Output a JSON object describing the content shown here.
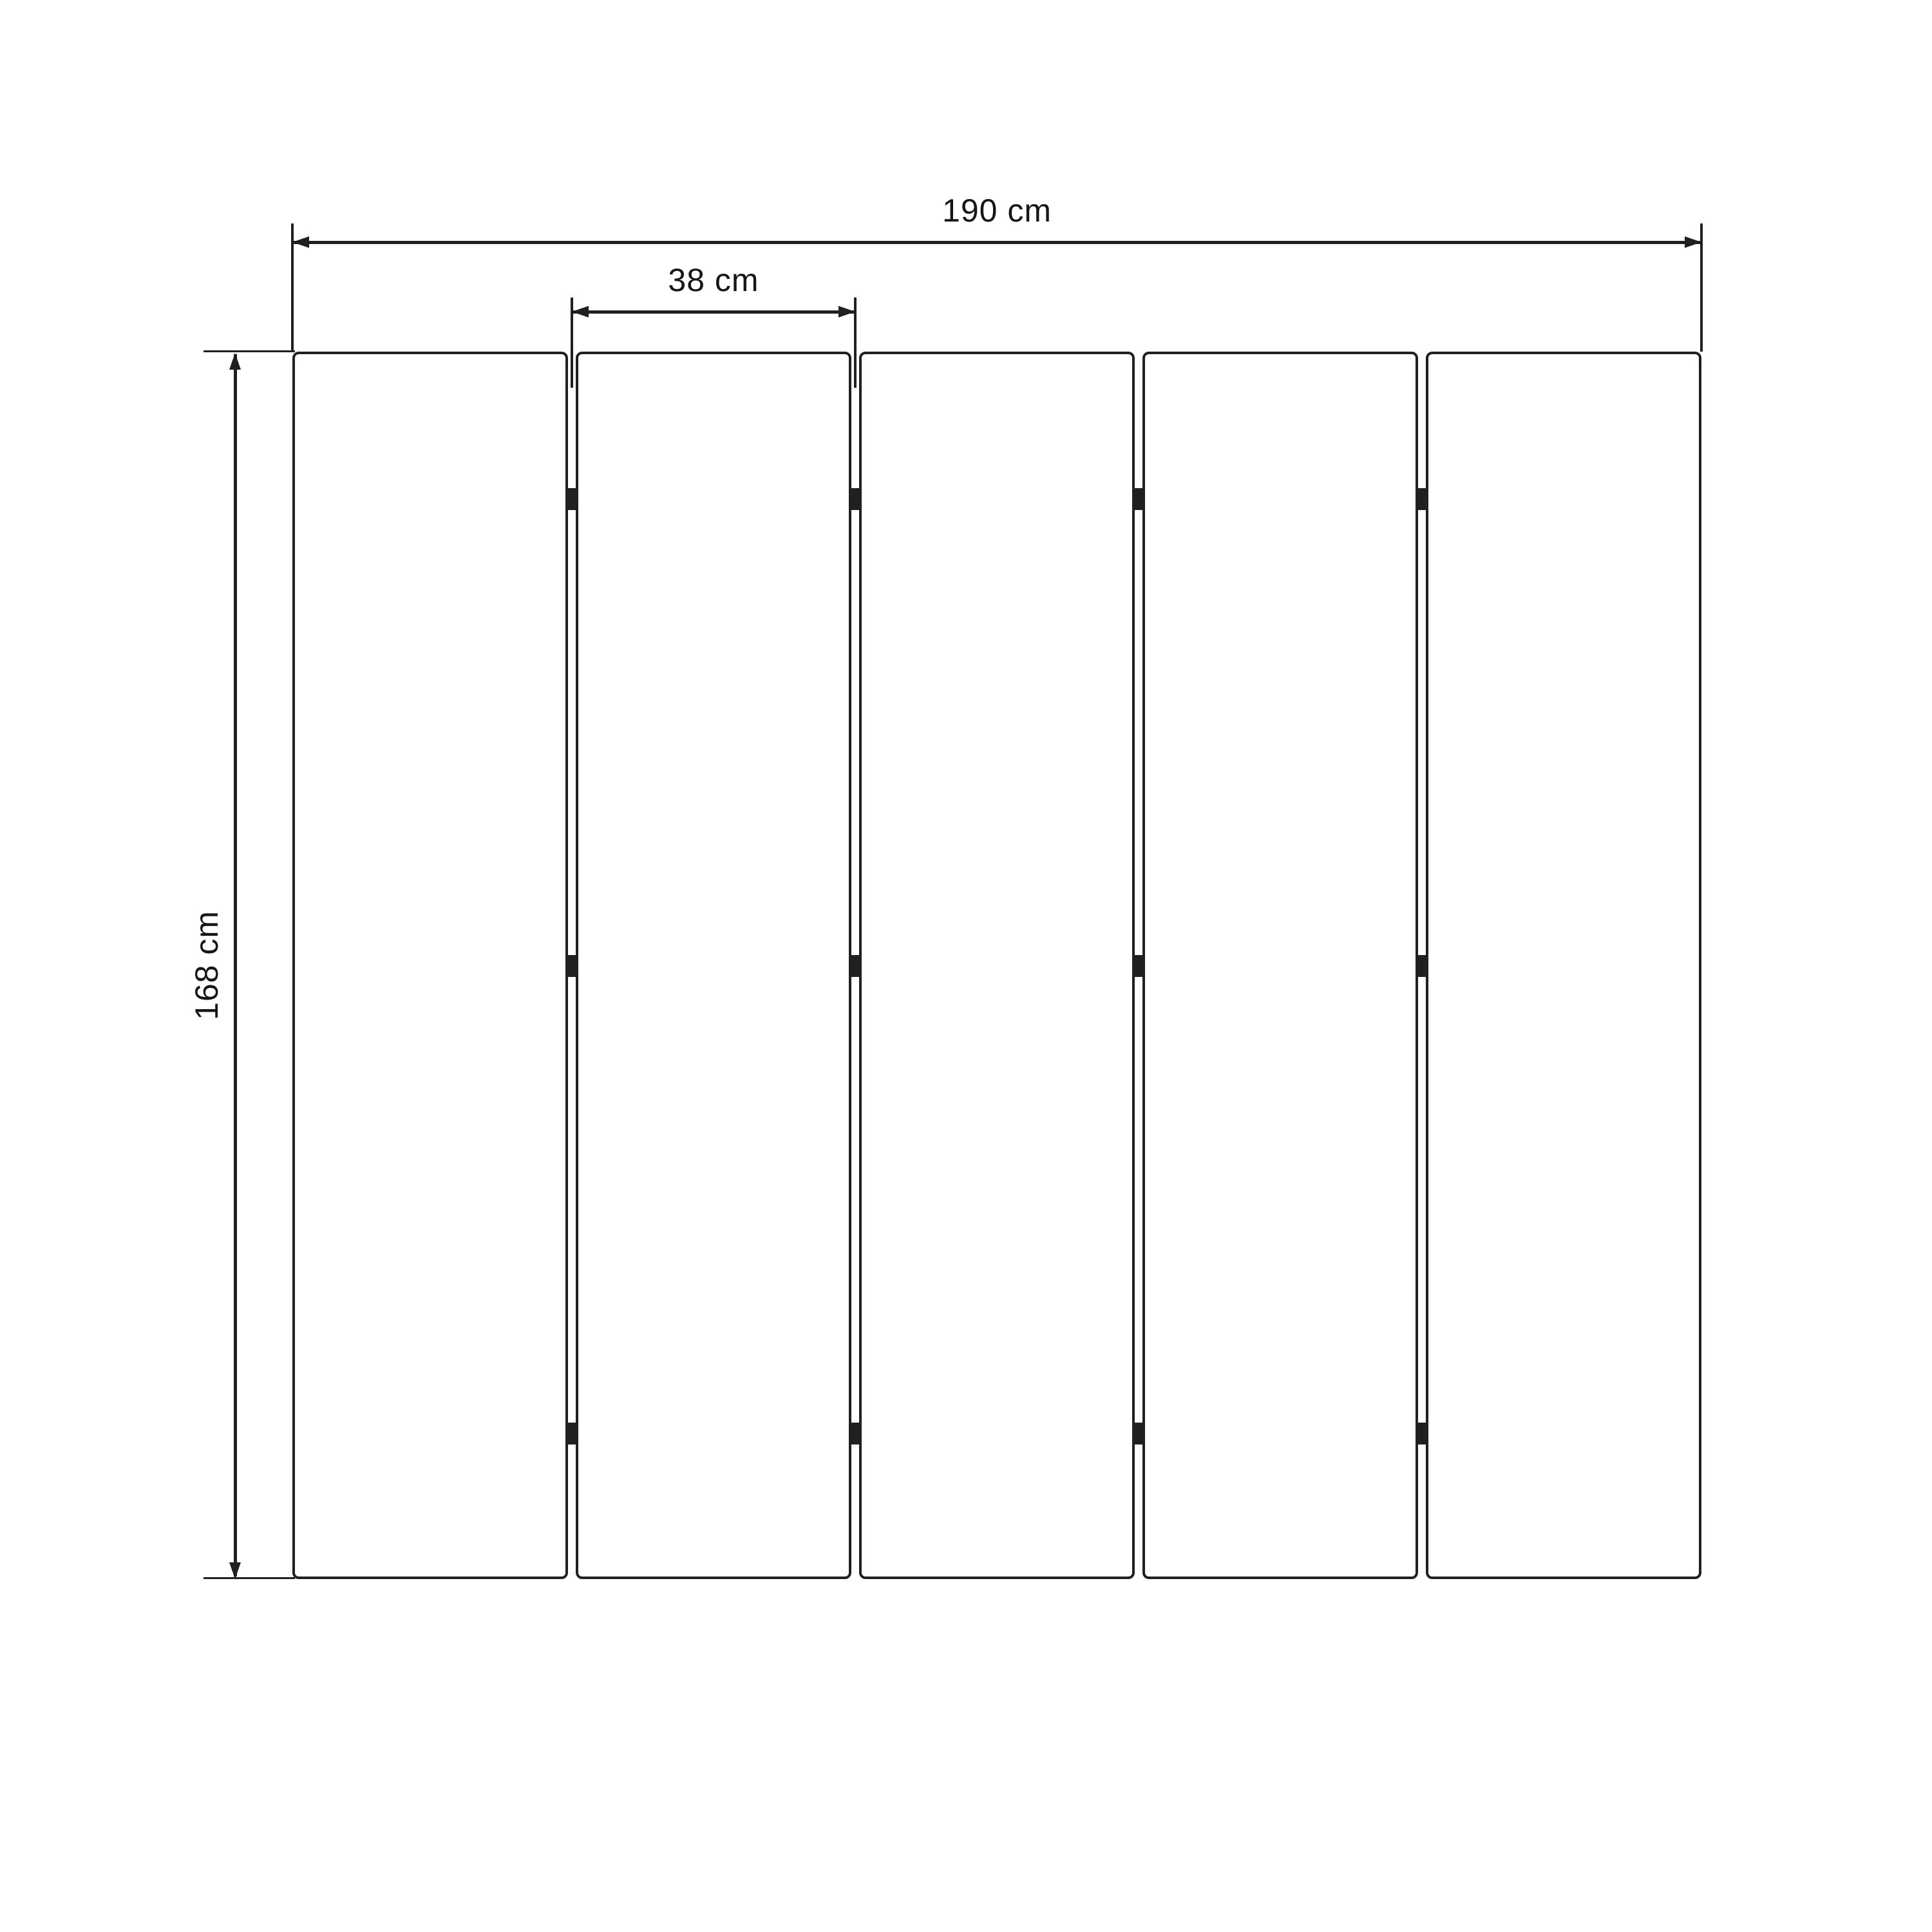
{
  "diagram": {
    "panel_count": 5,
    "hinge_rows_per_gap": 3,
    "colors": {
      "line": "#202020",
      "text": "#161616",
      "background": "#ffffff"
    },
    "dimensions": {
      "total_width": {
        "label": "190 cm",
        "value": 190,
        "unit": "cm"
      },
      "panel_width": {
        "label": "38 cm",
        "value": 38,
        "unit": "cm"
      },
      "height": {
        "label": "168 cm",
        "value": 168,
        "unit": "cm"
      }
    }
  }
}
